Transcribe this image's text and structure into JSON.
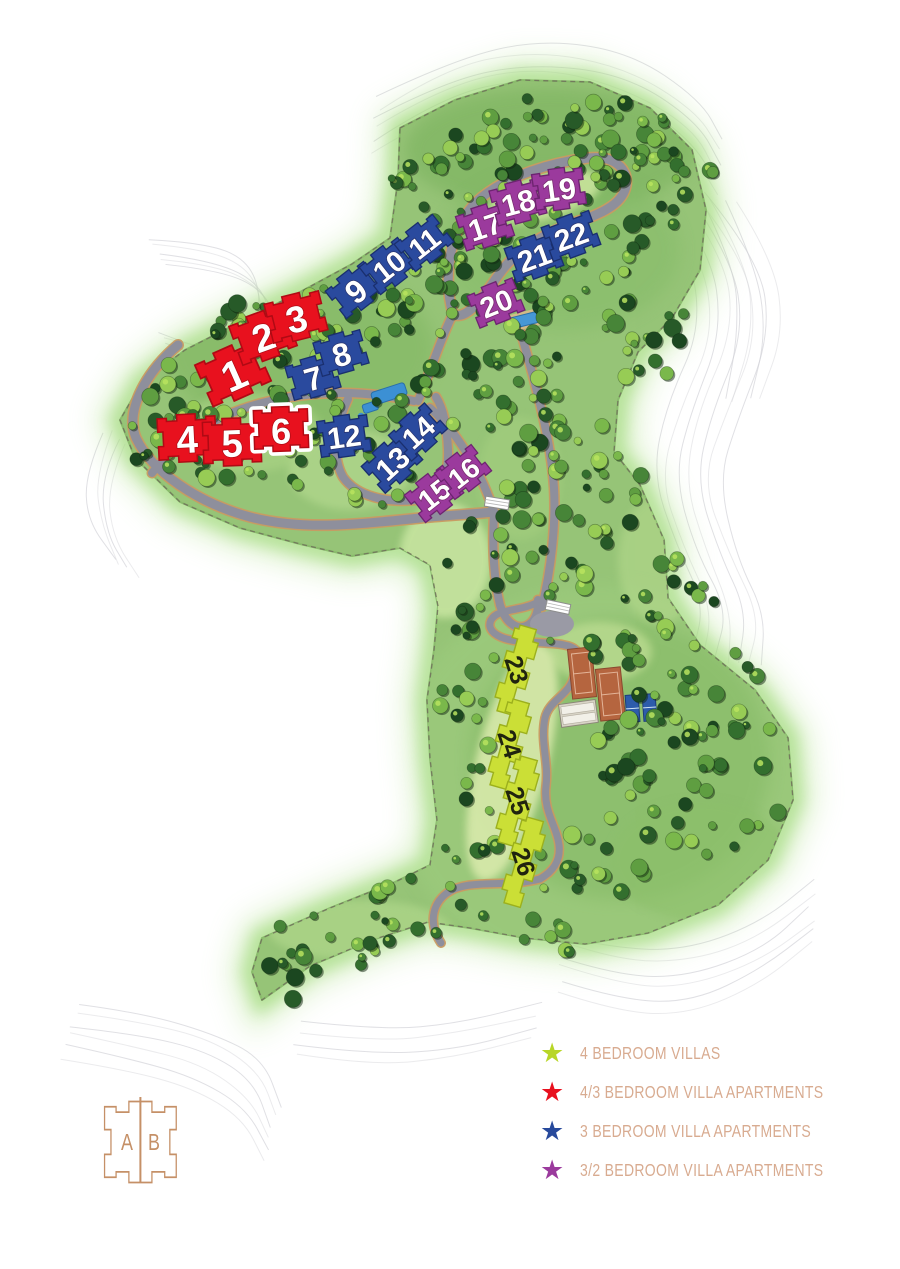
{
  "legend": {
    "items": [
      {
        "label": "4 BEDROOM VILLAS",
        "color": "#b8d627",
        "icon": "star-icon"
      },
      {
        "label": "4/3 BEDROOM VILLA APARTMENTS",
        "color": "#e8111e",
        "icon": "star-icon"
      },
      {
        "label": "3 BEDROOM VILLA APARTMENTS",
        "color": "#27499c",
        "icon": "star-icon"
      },
      {
        "label": "3/2 BEDROOM VILLA APARTMENTS",
        "color": "#9b3a9d",
        "icon": "star-icon"
      }
    ]
  },
  "logo": {
    "letters": [
      "A",
      "B"
    ]
  },
  "map": {
    "marker_types": {
      "red": {
        "legend": "4/3 BEDROOM VILLA APARTMENTS",
        "fill": "#e8111e",
        "stroke": "#b00a14",
        "text": "#ffffff"
      },
      "blue": {
        "legend": "3 BEDROOM VILLA APARTMENTS",
        "fill": "#2a4a9e",
        "stroke": "#1a2f6e",
        "text": "#ffffff"
      },
      "purple": {
        "legend": "3/2 BEDROOM VILLA APARTMENTS",
        "fill": "#9b3a9d",
        "stroke": "#6d2470",
        "text": "#ffffff"
      },
      "yellow": {
        "legend": "4 BEDROOM VILLAS",
        "fill": "#cbdf36",
        "stroke": "#9cb01d",
        "text": "#20240f"
      }
    },
    "highlighted_marker": "6",
    "markers": [
      {
        "number": "1",
        "type": "red",
        "x": 233,
        "y": 373,
        "rot": -24,
        "size": 68
      },
      {
        "number": "2",
        "type": "red",
        "x": 263,
        "y": 336,
        "rot": -20,
        "size": 62
      },
      {
        "number": "3",
        "type": "red",
        "x": 296,
        "y": 317,
        "rot": -14,
        "size": 60
      },
      {
        "number": "4",
        "type": "red",
        "x": 187,
        "y": 438,
        "rot": -3,
        "size": 62
      },
      {
        "number": "5",
        "type": "red",
        "x": 232,
        "y": 442,
        "rot": -2,
        "size": 62
      },
      {
        "number": "6",
        "type": "red",
        "x": 281,
        "y": 429,
        "rot": -2,
        "size": 58,
        "highlighted": true
      },
      {
        "number": "7",
        "type": "blue",
        "x": 313,
        "y": 377,
        "rot": -16,
        "size": 52
      },
      {
        "number": "8",
        "type": "blue",
        "x": 341,
        "y": 353,
        "rot": -16,
        "size": 52
      },
      {
        "number": "9",
        "type": "blue",
        "x": 355,
        "y": 290,
        "rot": -38,
        "size": 52
      },
      {
        "number": "10",
        "type": "blue",
        "x": 389,
        "y": 266,
        "rot": -38,
        "size": 52
      },
      {
        "number": "11",
        "type": "blue",
        "x": 424,
        "y": 243,
        "rot": -38,
        "size": 52
      },
      {
        "number": "12",
        "type": "blue",
        "x": 344,
        "y": 436,
        "rot": -8,
        "size": 54
      },
      {
        "number": "13",
        "type": "blue",
        "x": 392,
        "y": 463,
        "rot": -42,
        "size": 54
      },
      {
        "number": "14",
        "type": "blue",
        "x": 418,
        "y": 432,
        "rot": -42,
        "size": 52
      },
      {
        "number": "15",
        "type": "purple",
        "x": 434,
        "y": 494,
        "rot": -38,
        "size": 52
      },
      {
        "number": "16",
        "type": "purple",
        "x": 463,
        "y": 472,
        "rot": -38,
        "size": 50
      },
      {
        "number": "17",
        "type": "purple",
        "x": 485,
        "y": 226,
        "rot": -18,
        "size": 54
      },
      {
        "number": "18",
        "type": "purple",
        "x": 518,
        "y": 202,
        "rot": -15,
        "size": 54
      },
      {
        "number": "19",
        "type": "purple",
        "x": 559,
        "y": 189,
        "rot": -8,
        "size": 54
      },
      {
        "number": "20",
        "type": "purple",
        "x": 496,
        "y": 303,
        "rot": -22,
        "size": 52
      },
      {
        "number": "21",
        "type": "blue",
        "x": 534,
        "y": 257,
        "rot": -20,
        "size": 54
      },
      {
        "number": "22",
        "type": "blue",
        "x": 571,
        "y": 236,
        "rot": -20,
        "size": 54
      },
      {
        "number": "23",
        "type": "yellow",
        "x": 516,
        "y": 670,
        "rot": 16,
        "size": 31
      },
      {
        "number": "24",
        "type": "yellow",
        "x": 509,
        "y": 744,
        "rot": 16,
        "size": 31
      },
      {
        "number": "25",
        "type": "yellow",
        "x": 517,
        "y": 801,
        "rot": 16,
        "size": 31
      },
      {
        "number": "26",
        "type": "yellow",
        "x": 523,
        "y": 862,
        "rot": 16,
        "size": 31
      }
    ]
  }
}
